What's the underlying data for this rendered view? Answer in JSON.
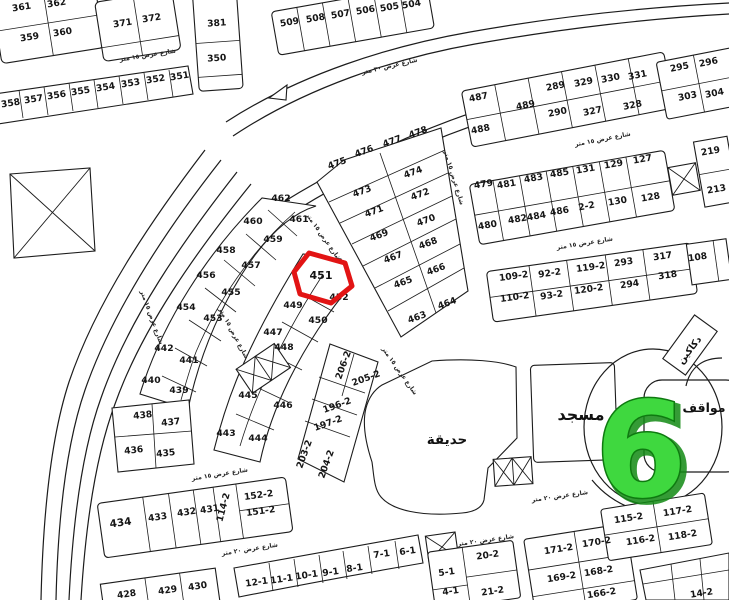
{
  "map": {
    "district_number": "6",
    "highlighted_plot": "451",
    "colors": {
      "ink": "#1c1c1c",
      "paper": "#ffffff",
      "highlight": "#e21414",
      "district_fill": "#3fd83f",
      "district_edge": "#0e7a10",
      "district_shadow": "#128a14"
    },
    "area_labels": [
      {
        "name": "mosque",
        "text": "مسجد",
        "x": 581,
        "y": 420,
        "s": 16,
        "r": 0
      },
      {
        "name": "garden",
        "text": "حديقة",
        "x": 447,
        "y": 444,
        "s": 13.5,
        "r": 0
      },
      {
        "name": "parking",
        "text": "مواقف",
        "x": 704,
        "y": 412,
        "s": 12.5,
        "r": 0
      },
      {
        "name": "shops",
        "text": "دكاكين",
        "x": 692,
        "y": 352,
        "s": 9.5,
        "r": -52
      }
    ],
    "street_labels": [
      [
        "شارع عرض ١٥ متر",
        148,
        57,
        -9
      ],
      [
        "شارع عرض ٣٠ متر",
        390,
        68,
        -13
      ],
      [
        "شارع عرض ١٥ متر",
        603,
        141,
        -11
      ],
      [
        "شارع عرض ١٥ متر",
        585,
        245,
        -9
      ],
      [
        "شارع عرض ١٥ متر",
        452,
        178,
        73
      ],
      [
        "شارع عرض ١٥ متر",
        322,
        238,
        55
      ],
      [
        "شارع عرض ١٥ متر",
        150,
        318,
        70
      ],
      [
        "شارع عرض ١٥ متر",
        232,
        334,
        62
      ],
      [
        "شارع عرض ١٥ متر",
        398,
        372,
        55
      ],
      [
        "شارع عرض ١٥ متر",
        220,
        476,
        -9
      ],
      [
        "شارع عرض ٢٠ متر",
        250,
        551,
        -9
      ],
      [
        "شارع عرض ٢٠ متر",
        560,
        498,
        -8
      ],
      [
        "شارع عرض ٢٠ متر",
        486,
        542,
        -8
      ]
    ],
    "plots": [
      [
        "361",
        22,
        10,
        -9
      ],
      [
        "362",
        57,
        6,
        -9
      ],
      [
        "359",
        30,
        40,
        -9
      ],
      [
        "360",
        63,
        35,
        -9
      ],
      [
        "371",
        123,
        26,
        -9
      ],
      [
        "372",
        152,
        21,
        -9
      ],
      [
        "381",
        217,
        26,
        -4
      ],
      [
        "350",
        217,
        61,
        -4
      ],
      [
        "358",
        11,
        106,
        -9
      ],
      [
        "357",
        34,
        102,
        -9
      ],
      [
        "356",
        57,
        98,
        -9
      ],
      [
        "355",
        81,
        94,
        -9
      ],
      [
        "354",
        106,
        90,
        -9
      ],
      [
        "353",
        131,
        86,
        -9
      ],
      [
        "352",
        156,
        82,
        -9
      ],
      [
        "351",
        180,
        79,
        -9
      ],
      [
        "509",
        290,
        25,
        -10
      ],
      [
        "508",
        316,
        21,
        -10
      ],
      [
        "507",
        341,
        17,
        -10
      ],
      [
        "506",
        366,
        13,
        -10
      ],
      [
        "505",
        390,
        10,
        -10
      ],
      [
        "504",
        412,
        7,
        -10
      ],
      [
        "487",
        479,
        100,
        -11
      ],
      [
        "488",
        481,
        132,
        -11
      ],
      [
        "289",
        556,
        89,
        -11
      ],
      [
        "329",
        584,
        85,
        -11
      ],
      [
        "330",
        611,
        81,
        -11
      ],
      [
        "331",
        638,
        78,
        -11
      ],
      [
        "489",
        526,
        108,
        -11
      ],
      [
        "290",
        558,
        115,
        -11
      ],
      [
        "327",
        593,
        114,
        -11
      ],
      [
        "328",
        633,
        108,
        -11
      ],
      [
        "295",
        680,
        70,
        -11
      ],
      [
        "296",
        709,
        65,
        -11
      ],
      [
        "303",
        688,
        99,
        -11
      ],
      [
        "304",
        715,
        96,
        -11
      ],
      [
        "479",
        484,
        187,
        -10
      ],
      [
        "481",
        507,
        187,
        -10
      ],
      [
        "483",
        534,
        181,
        -10
      ],
      [
        "485",
        560,
        176,
        -10
      ],
      [
        "131",
        586,
        172,
        -10
      ],
      [
        "129",
        614,
        167,
        -10
      ],
      [
        "127",
        643,
        162,
        -10
      ],
      [
        "480",
        488,
        228,
        -10
      ],
      [
        "482",
        518,
        222,
        -10
      ],
      [
        "484",
        537,
        219,
        -10
      ],
      [
        "486",
        560,
        214,
        -10
      ],
      [
        "2-2",
        587,
        209,
        -10
      ],
      [
        "130",
        618,
        204,
        -10
      ],
      [
        "128",
        651,
        200,
        -10
      ],
      [
        "219",
        711,
        154,
        -10
      ],
      [
        "213",
        717,
        192,
        -10
      ],
      [
        "109-2",
        514,
        279,
        -8
      ],
      [
        "92-2",
        550,
        276,
        -8
      ],
      [
        "119-2",
        591,
        270,
        -8
      ],
      [
        "293",
        624,
        265,
        -8
      ],
      [
        "317",
        663,
        259,
        -8
      ],
      [
        "108",
        698,
        260,
        -8
      ],
      [
        "110-2",
        515,
        300,
        -8
      ],
      [
        "93-2",
        552,
        298,
        -8
      ],
      [
        "120-2",
        589,
        292,
        -8
      ],
      [
        "294",
        630,
        287,
        -8
      ],
      [
        "318",
        668,
        278,
        -8
      ],
      [
        "475",
        338,
        166,
        -20
      ],
      [
        "476",
        365,
        154,
        -20
      ],
      [
        "477",
        393,
        144,
        -20
      ],
      [
        "478",
        419,
        135,
        -20
      ],
      [
        "473",
        363,
        194,
        -20
      ],
      [
        "474",
        414,
        175,
        -20
      ],
      [
        "471",
        375,
        214,
        -20
      ],
      [
        "472",
        421,
        197,
        -20
      ],
      [
        "469",
        380,
        238,
        -20
      ],
      [
        "470",
        427,
        223,
        -20
      ],
      [
        "467",
        394,
        260,
        -20
      ],
      [
        "468",
        429,
        246,
        -20
      ],
      [
        "465",
        404,
        285,
        -20
      ],
      [
        "466",
        437,
        272,
        -20
      ],
      [
        "463",
        418,
        320,
        -20
      ],
      [
        "464",
        448,
        306,
        -20
      ],
      [
        "462",
        281,
        201,
        0
      ],
      [
        "461",
        299,
        222,
        0
      ],
      [
        "460",
        253,
        224,
        0
      ],
      [
        "459",
        273,
        242,
        0
      ],
      [
        "458",
        226,
        253,
        0
      ],
      [
        "457",
        251,
        268,
        0
      ],
      [
        "456",
        206,
        278,
        0
      ],
      [
        "455",
        231,
        295,
        0
      ],
      [
        "454",
        186,
        310,
        0
      ],
      [
        "453",
        213,
        321,
        0
      ],
      [
        "442",
        164,
        351,
        0
      ],
      [
        "441",
        189,
        363,
        0
      ],
      [
        "440",
        151,
        383,
        0
      ],
      [
        "439",
        179,
        393,
        0
      ],
      [
        "438",
        143,
        418,
        -6
      ],
      [
        "437",
        171,
        425,
        -6
      ],
      [
        "436",
        134,
        453,
        -6
      ],
      [
        "435",
        166,
        456,
        -6
      ],
      [
        "451",
        321,
        279,
        0,
        11
      ],
      [
        "452",
        339,
        300,
        0
      ],
      [
        "449",
        293,
        308,
        0
      ],
      [
        "450",
        318,
        323,
        0
      ],
      [
        "447",
        273,
        335,
        0
      ],
      [
        "448",
        284,
        350,
        0
      ],
      [
        "445",
        248,
        398,
        0
      ],
      [
        "446",
        283,
        408,
        0
      ],
      [
        "443",
        226,
        436,
        0
      ],
      [
        "444",
        258,
        441,
        0
      ],
      [
        "206-2",
        346,
        366,
        -70
      ],
      [
        "205-2",
        367,
        381,
        -20
      ],
      [
        "196-2",
        338,
        408,
        -20
      ],
      [
        "197-2",
        329,
        426,
        -20
      ],
      [
        "203-2",
        307,
        455,
        -70
      ],
      [
        "204-2",
        329,
        465,
        -70
      ],
      [
        "434",
        121,
        526,
        -8,
        10.5
      ],
      [
        "433",
        158,
        520,
        -8
      ],
      [
        "432",
        187,
        515,
        -8
      ],
      [
        "431",
        210,
        512,
        -8
      ],
      [
        "114-2",
        226,
        508,
        -75
      ],
      [
        "152-2",
        259,
        498,
        -8
      ],
      [
        "151-2",
        261,
        514,
        -8
      ],
      [
        "428",
        127,
        597,
        -8
      ],
      [
        "429",
        168,
        593,
        -8
      ],
      [
        "430",
        198,
        589,
        -8
      ],
      [
        "12-1",
        257,
        585,
        -8
      ],
      [
        "11-1",
        282,
        582,
        -8
      ],
      [
        "10-1",
        307,
        578,
        -8
      ],
      [
        "9-1",
        331,
        575,
        -8
      ],
      [
        "8-1",
        355,
        571,
        -8
      ],
      [
        "7-1",
        382,
        557,
        -8
      ],
      [
        "6-1",
        408,
        554,
        -8
      ],
      [
        "5-1",
        447,
        575,
        -8
      ],
      [
        "4-1",
        451,
        594,
        -8
      ],
      [
        "20-2",
        488,
        558,
        -8
      ],
      [
        "21-2",
        493,
        594,
        -8
      ],
      [
        "171-2",
        559,
        552,
        -9
      ],
      [
        "170-2",
        597,
        545,
        -9
      ],
      [
        "169-2",
        562,
        580,
        -9
      ],
      [
        "168-2",
        599,
        574,
        -9
      ],
      [
        "166-2",
        602,
        596,
        -9
      ],
      [
        "115-2",
        629,
        521,
        -9
      ],
      [
        "117-2",
        678,
        514,
        -9
      ],
      [
        "116-2",
        641,
        543,
        -9
      ],
      [
        "118-2",
        683,
        538,
        -9
      ],
      [
        "14-2",
        702,
        596,
        -9
      ]
    ]
  }
}
